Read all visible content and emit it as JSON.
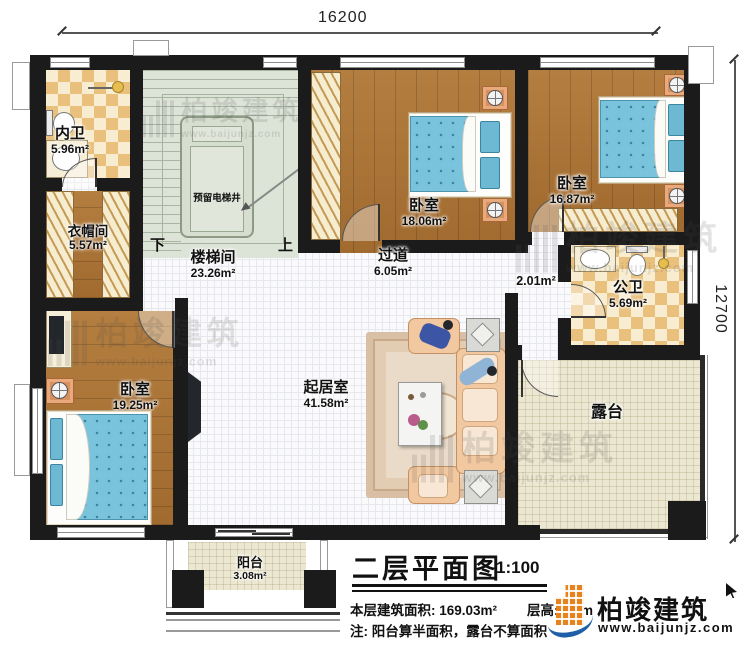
{
  "dimensions": {
    "top_width": "16200",
    "right_height": "12700"
  },
  "rooms": {
    "ensuite_bath": {
      "name": "内卫",
      "area": "5.96m²"
    },
    "cloakroom": {
      "name": "衣帽间",
      "area": "5.57m²"
    },
    "bedroom_left": {
      "name": "卧室",
      "area": "19.25m²"
    },
    "stair_hall": {
      "name": "楼梯间",
      "area": "23.26m²"
    },
    "elevator_shaft": {
      "name": "预留电梯井"
    },
    "stair_down": "下",
    "stair_up": "上",
    "bedroom_middle": {
      "name": "卧室",
      "area": "18.06m²"
    },
    "bedroom_right": {
      "name": "卧室",
      "area": "16.87m²"
    },
    "corridor": {
      "name": "过道",
      "area": "6.05m²"
    },
    "small_hall": {
      "area": "2.01m²"
    },
    "public_bath": {
      "name": "公卫",
      "area": "5.69m²"
    },
    "living_room": {
      "name": "起居室",
      "area": "41.58m²"
    },
    "terrace": {
      "name": "露台"
    },
    "balcony": {
      "name": "阳台",
      "area": "3.08m²"
    }
  },
  "title_block": {
    "title": "二层平面图",
    "scale": "1:100",
    "area_line": "本层建筑面积: 169.03m²",
    "height_line": "层高: 3.3m",
    "note_line": "注: 阳台算半面积，露台不算面积"
  },
  "branding": {
    "company": "柏竣建筑",
    "website": "www.baijunjz.com"
  },
  "watermark": {
    "company": "柏竣建筑",
    "website": "www.baijunjz.com"
  },
  "colors": {
    "wall": "#1b1b1b",
    "wood_floor": "#a97336",
    "tile_dark": "#e9c17d",
    "tile_light": "#f8edd1",
    "stair_floor": "#dce3d7",
    "terrace_floor": "#ece7d1",
    "bed_blue": "#79c4dc",
    "logo_orange": "#e8821e",
    "logo_blue": "#1e5fa8"
  }
}
